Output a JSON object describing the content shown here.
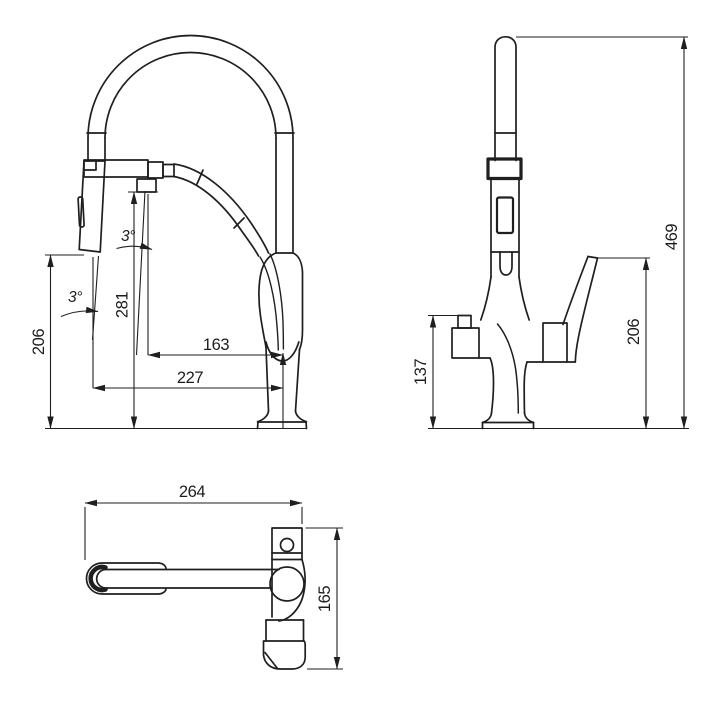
{
  "page": {
    "background": "#ffffff",
    "line_color": "#1f1f1f"
  },
  "views": {
    "front": {
      "dims": {
        "spray_height": "206",
        "spout_height": "281",
        "spout_reach": "163",
        "spray_reach": "227",
        "spout_angle": "3°",
        "spray_angle": "3°"
      }
    },
    "side": {
      "dims": {
        "overall_height": "469",
        "outlet_height": "137",
        "handle_height": "206"
      }
    },
    "top": {
      "dims": {
        "length": "264",
        "depth": "165"
      }
    }
  }
}
